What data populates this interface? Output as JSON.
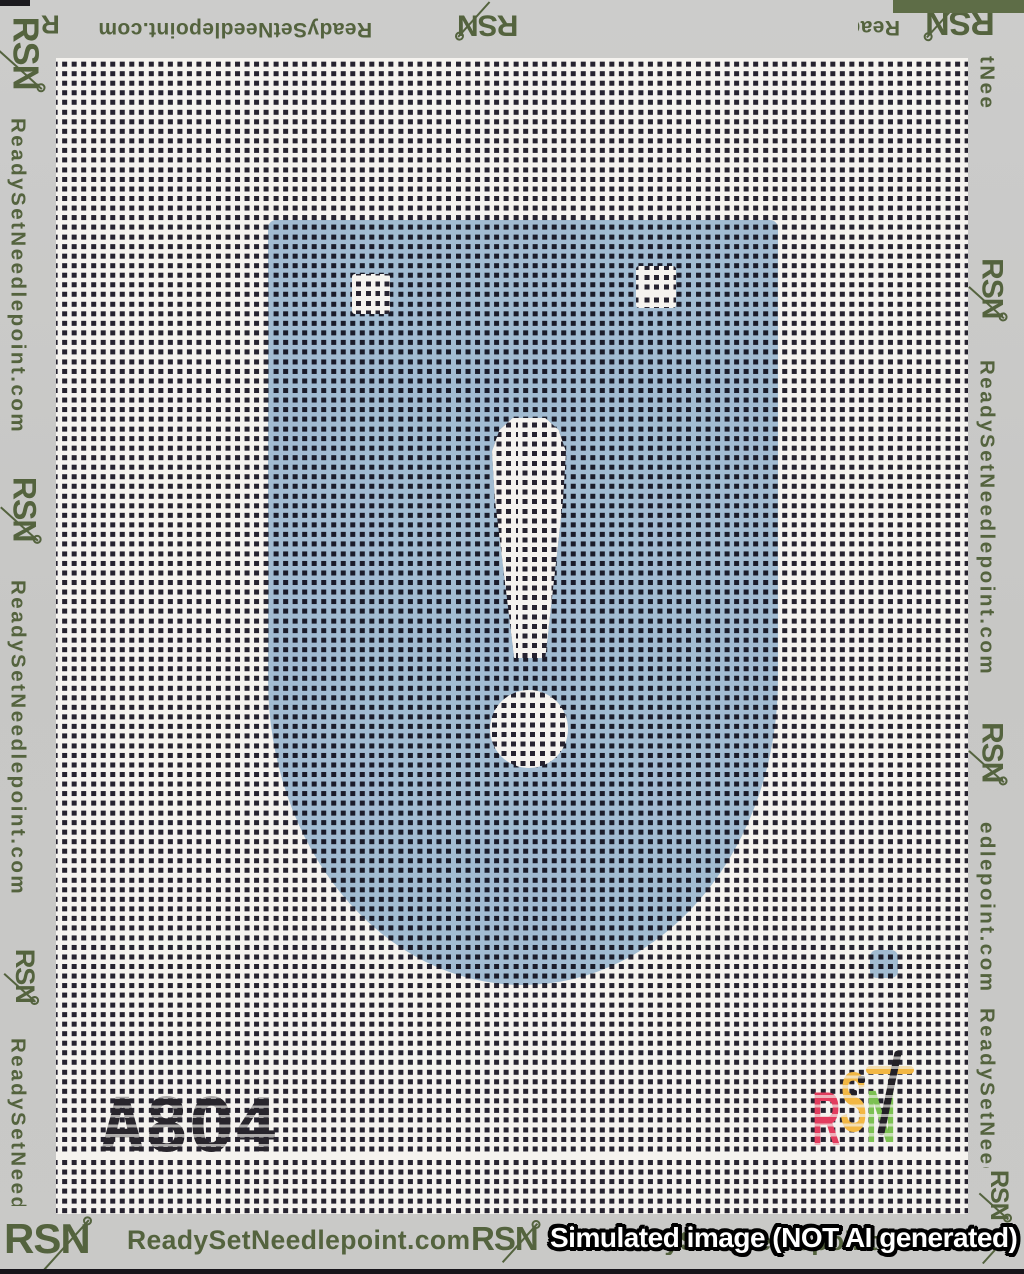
{
  "brand": {
    "website": "ReadySetNeedlepoint.com",
    "logo": "RSN",
    "olive_color": "#54633e"
  },
  "canvas": {
    "design_code": "A8O4",
    "shield_color": "#a9c6e0",
    "mesh_thread_color": "#f5f3ef",
    "mesh_hole_color": "#262330"
  },
  "stitched_logo": {
    "r": "R",
    "s": "S",
    "n": "N",
    "r_color": "#e23c5e",
    "s_color": "#f2b744",
    "n_color": "#7cc152",
    "needle_color": "#232026"
  },
  "watermark": "Simulated image (NOT AI generated)",
  "fragments": {
    "top_r": "R",
    "right_top": "tNee",
    "right_mid": "edlepoint.com"
  }
}
